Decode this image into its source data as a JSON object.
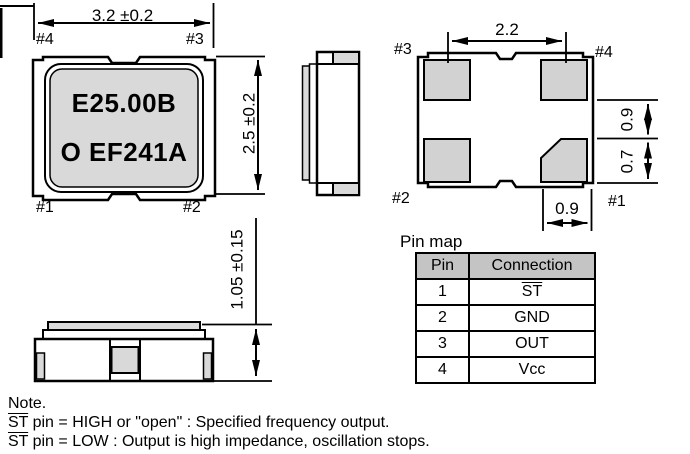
{
  "colors": {
    "line": "#000000",
    "lid_fill": "#d9d9d9",
    "pad_fill": "#d2d2d2",
    "table_header_bg": "#c4c4c4",
    "background": "#ffffff"
  },
  "front_view": {
    "marking_line1": "E25.00B",
    "marking_line2": "O EF241A",
    "dim_width": "3.2 ±0.2",
    "dim_height": "2.5 ±0.2",
    "pin_top_left": "#4",
    "pin_top_right": "#3",
    "pin_bottom_left": "#1",
    "pin_bottom_right": "#2"
  },
  "bottom_view": {
    "dim_pad_pitch": "2.2",
    "dim_pad_gap": "0.9",
    "dim_pad_height": "0.7",
    "dim_pad_width": "0.9",
    "pin_top_left": "#3",
    "pin_top_right": "#4",
    "pin_bottom_left": "#2",
    "pin_bottom_right": "#1"
  },
  "side_view": {
    "dim_thickness": "1.05 ±0.15"
  },
  "pin_map": {
    "title": "Pin map",
    "headers": [
      "Pin",
      "Connection"
    ],
    "rows": [
      {
        "pin": "1",
        "connection": "ST"
      },
      {
        "pin": "2",
        "connection": "GND"
      },
      {
        "pin": "3",
        "connection": "OUT"
      },
      {
        "pin": "4",
        "connection": "Vcc"
      }
    ]
  },
  "note": {
    "title": "Note.",
    "line1_st": "ST",
    "line1_rest": " pin = HIGH or \"open\" : Specified frequency output.",
    "line2_st": "ST",
    "line2_rest": " pin = LOW : Output is high impedance, oscillation stops."
  }
}
